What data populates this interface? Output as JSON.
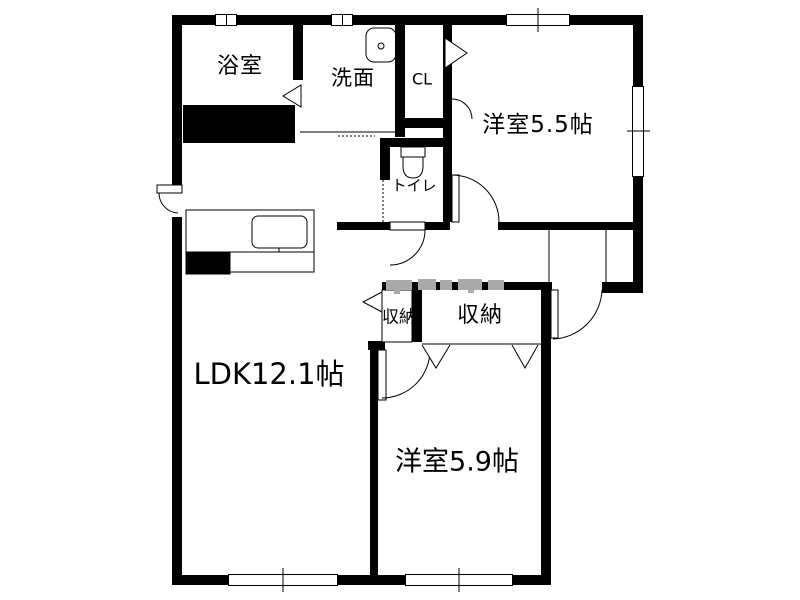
{
  "floorplan": {
    "type": "apartment-floor-plan",
    "rooms": {
      "bathroom": {
        "label": "浴室"
      },
      "washroom": {
        "label": "洗面"
      },
      "closet_cl": {
        "label": "CL"
      },
      "bedroom_a": {
        "label": "洋室5.5帖"
      },
      "toilet": {
        "label": "トイレ"
      },
      "storage_small": {
        "label": "収納"
      },
      "storage_large": {
        "label": "収納"
      },
      "ldk": {
        "label": "LDK12.1帖"
      },
      "bedroom_b": {
        "label": "洋室5.9帖"
      }
    },
    "colors": {
      "wall": "#000000",
      "floor": "#ffffff",
      "watermark": "#a9a9a9"
    }
  }
}
